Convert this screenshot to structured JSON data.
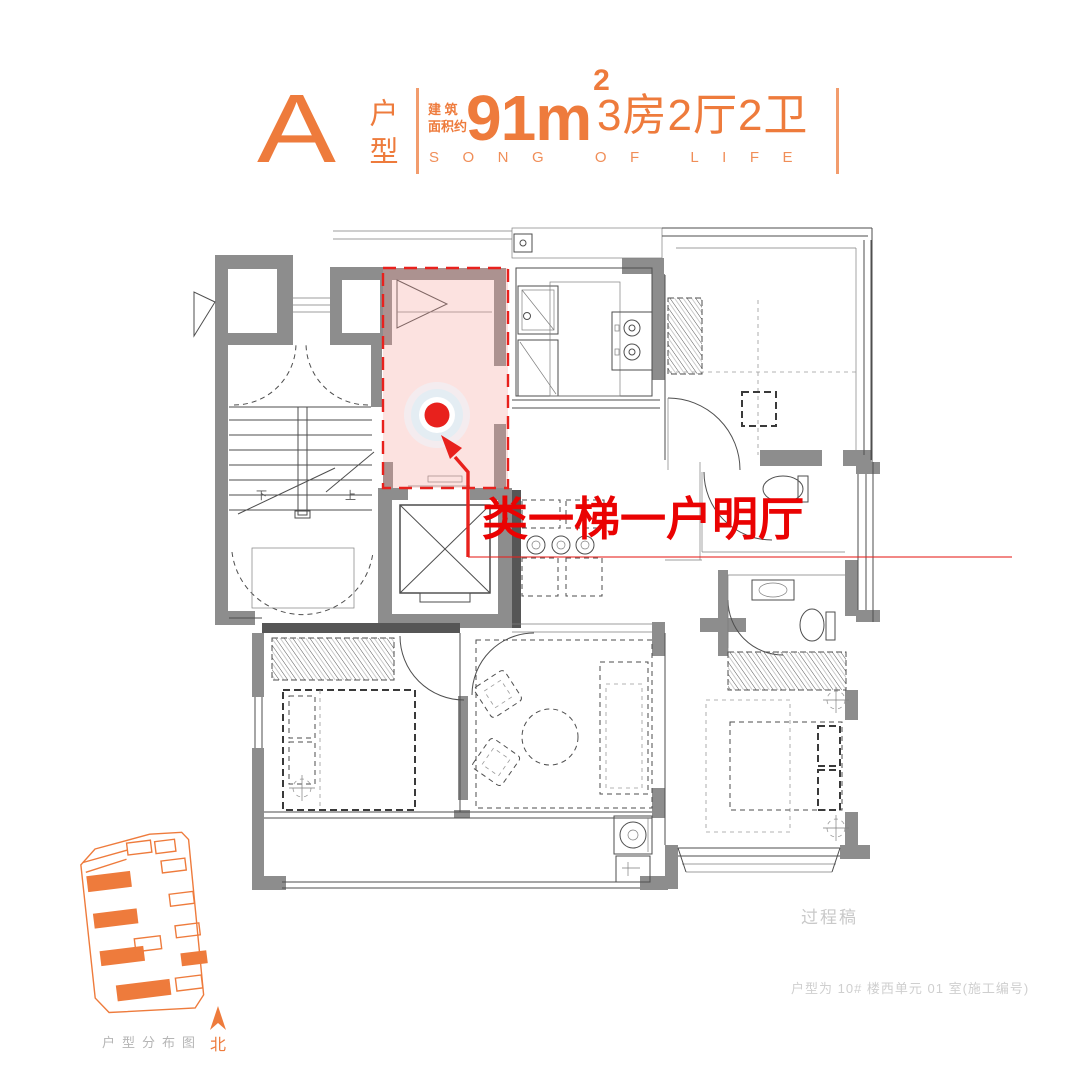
{
  "colors": {
    "accent": "#ee7b3c",
    "marker": "#e8211d",
    "callout": "#ea0202",
    "wall": "#8d8d8d",
    "muted_text": "#c9c9c9",
    "highlight_fill": "rgba(246,158,152,0.30)"
  },
  "header": {
    "type_letter": "A",
    "type_label": "户型",
    "area_label_line1": "建 筑",
    "area_label_line2": "面积约",
    "area_value": "91m",
    "area_exponent": "2",
    "rooms_summary": "3房2厅2卫",
    "tagline": "SONG OF LIFE"
  },
  "plan": {
    "callout": "类一梯一户明厅",
    "stair_up": "上",
    "stair_down": "下"
  },
  "sitemap": {
    "caption": "户型分布图",
    "compass_label": "北"
  },
  "footer": {
    "watermark": "过程稿",
    "note": "户型为 10# 楼西单元 01 室(施工编号)"
  }
}
